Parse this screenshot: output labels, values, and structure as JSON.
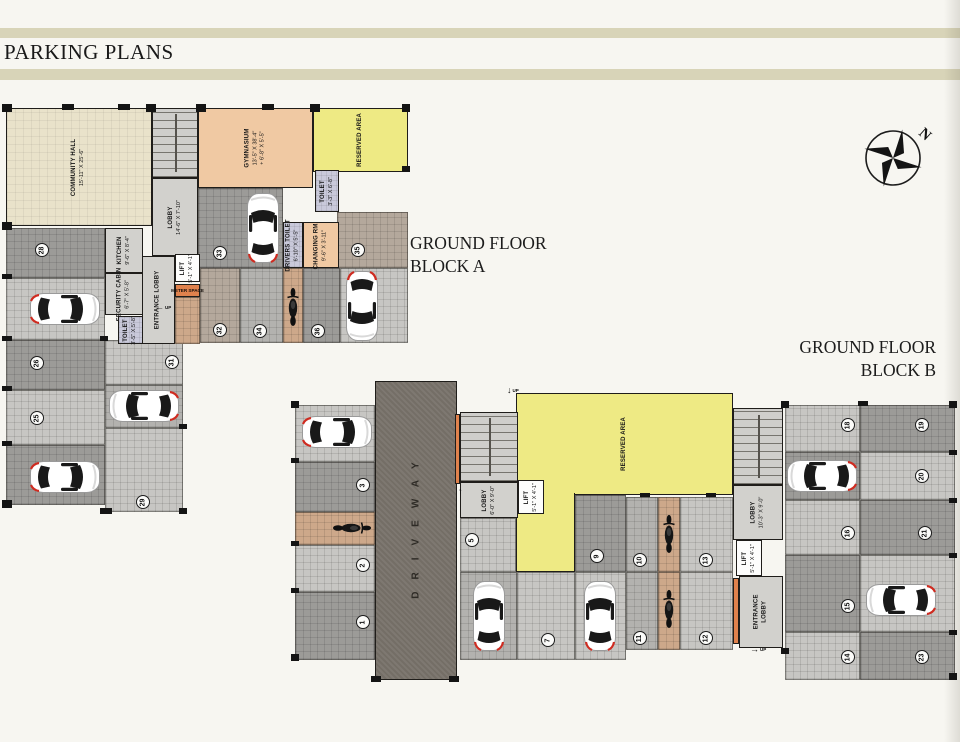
{
  "title": "PARKING PLANS",
  "compass_label": "N",
  "headings": {
    "block_a": [
      "GROUND FLOOR",
      "BLOCK A"
    ],
    "block_b": [
      "GROUND FLOOR",
      "BLOCK B"
    ]
  },
  "colors": {
    "paper": "#f7f6f1",
    "title_bar": "#d8d4b8",
    "reserved_yellow": "#eeea84",
    "gym_peach": "#f0c9a3",
    "hall_cream": "#e9e2ca",
    "toilet_lavender": "#c9c9da",
    "driveway_gray": "#746e66",
    "accent_orange": "#e0824d",
    "car_tail_red": "#cf2b20"
  },
  "block_a": {
    "rooms": {
      "community_hall": {
        "line1": "COMMUNITY HALL",
        "line2": "15'-11\" X 25'-6\""
      },
      "lobby": {
        "line1": "LOBBY",
        "line2": "14'-6\" X 7'-10\""
      },
      "gymnasium": {
        "line1": "GYMNASIUM",
        "line2": "13'-5\" X 38'-4\"",
        "line3": "+ 6'-8\" X 5'-5\""
      },
      "reserved": {
        "line1": "RESERVED AREA"
      },
      "toilet_top": {
        "line1": "TOILET",
        "line2": "3'-3\" X 6'-8\""
      },
      "kitchen": {
        "line1": "KITCHEN",
        "line2": "9'-6\" X 8'-4\""
      },
      "entrance_lobby": {
        "line1": "ENTRANCE LOBBY"
      },
      "lift": {
        "line1": "LIFT",
        "line2": "5'-1\" X 4'-1\""
      },
      "meter_space": {
        "line1": "METER SPACE"
      },
      "security_cabin": {
        "line1": "SECURITY CABIN",
        "line2": "6'-7\" X 5'-8\""
      },
      "toilet_small": {
        "line1": "TOILET",
        "line2": "3'-5\" X 5'-8\""
      },
      "drivers_toilet": {
        "line1": "DRIVERS TOILET",
        "line2": "6'-10\" X 5'-5\""
      },
      "changing_room": {
        "line1": "CHANGING RM.",
        "line2": "9'-6\" X 3'-11\""
      }
    },
    "floors": [
      [
        "s28",
        6,
        228,
        99,
        50,
        "tile-dark"
      ],
      [
        "s27",
        6,
        278,
        99,
        62,
        "tile-light"
      ],
      [
        "s26",
        6,
        340,
        99,
        50,
        "tile-dark"
      ],
      [
        "s25",
        6,
        390,
        99,
        55,
        "tile-light"
      ],
      [
        "s24",
        6,
        445,
        99,
        60,
        "tile-dark"
      ],
      [
        "s31",
        105,
        340,
        78,
        45,
        "tile-light"
      ],
      [
        "s30",
        105,
        385,
        78,
        43,
        "tile-mid"
      ],
      [
        "s29",
        105,
        428,
        78,
        84,
        "tile-light"
      ],
      [
        "s33",
        198,
        188,
        85,
        80,
        "tile-dark"
      ],
      [
        "s32",
        200,
        268,
        40,
        75,
        "tile-brown"
      ],
      [
        "s34",
        240,
        268,
        43,
        75,
        "tile-mid"
      ],
      [
        "moto-strip",
        283,
        268,
        20,
        75,
        "tile-orange"
      ],
      [
        "s36",
        303,
        268,
        37,
        75,
        "tile-dark"
      ],
      [
        "s35-car",
        340,
        268,
        68,
        75,
        "tile-light"
      ],
      [
        "s35-top",
        337,
        212,
        71,
        56,
        "tile-brown"
      ],
      [
        "corridor",
        175,
        297,
        25,
        47,
        "tile-orange"
      ]
    ],
    "spots": [
      {
        "num": 28,
        "x": 42,
        "y": 250
      },
      {
        "num": 26,
        "x": 37,
        "y": 363
      },
      {
        "num": 25,
        "x": 37,
        "y": 418
      },
      {
        "num": 31,
        "x": 172,
        "y": 362
      },
      {
        "num": 29,
        "x": 143,
        "y": 502
      },
      {
        "num": 33,
        "x": 220,
        "y": 253
      },
      {
        "num": 32,
        "x": 220,
        "y": 330
      },
      {
        "num": 34,
        "x": 260,
        "y": 331
      },
      {
        "num": 36,
        "x": 318,
        "y": 331
      },
      {
        "num": 35,
        "x": 358,
        "y": 250
      }
    ],
    "cars": [
      {
        "x": 65,
        "y": 309,
        "deg": 90
      },
      {
        "x": 65,
        "y": 477,
        "deg": 90
      },
      {
        "x": 144,
        "y": 406,
        "deg": -90
      },
      {
        "x": 263,
        "y": 228,
        "deg": 0
      },
      {
        "x": 362,
        "y": 306,
        "deg": 180
      }
    ],
    "motorcycles": [
      {
        "x": 293,
        "y": 307,
        "deg": 0
      }
    ]
  },
  "block_b": {
    "rooms": {
      "driveway": {
        "line1": "DRIVEWAY"
      },
      "lobby_left": {
        "line1": "LOBBY",
        "line2": "6'-0\" X 9'-0\""
      },
      "lift_left": {
        "line1": "LIFT",
        "line2": "5'-1\" X 4'-1\""
      },
      "reserved": {
        "line1": "RESERVED AREA"
      },
      "lobby_right": {
        "line1": "LOBBY",
        "line2": "10'-3\" X 9'-0\""
      },
      "lift_right": {
        "line1": "LIFT",
        "line2": "5'-1\" X 4'-1\""
      },
      "entrance_lobby": {
        "line1": "ENTRANCE",
        "line2": "LOBBY"
      }
    },
    "floors": [
      [
        "s4",
        295,
        405,
        80,
        57,
        "tile-light"
      ],
      [
        "s3",
        295,
        462,
        80,
        50,
        "tile-dark"
      ],
      [
        "moto-strip1",
        295,
        512,
        80,
        33,
        "tile-orange"
      ],
      [
        "s2",
        295,
        545,
        80,
        47,
        "tile-light"
      ],
      [
        "s1",
        295,
        592,
        80,
        68,
        "tile-dark"
      ],
      [
        "s5",
        460,
        518,
        56,
        54,
        "tile-light"
      ],
      [
        "s6",
        460,
        572,
        57,
        88,
        "tile-mid"
      ],
      [
        "s7",
        517,
        572,
        58,
        88,
        "tile-light"
      ],
      [
        "s9",
        575,
        495,
        51,
        77,
        "tile-dark"
      ],
      [
        "s8",
        575,
        572,
        51,
        88,
        "tile-light"
      ],
      [
        "s10",
        626,
        497,
        32,
        75,
        "tile-mid"
      ],
      [
        "moto-strip2",
        658,
        497,
        22,
        75,
        "tile-orange"
      ],
      [
        "s13",
        680,
        497,
        53,
        75,
        "tile-light"
      ],
      [
        "s11",
        626,
        572,
        32,
        78,
        "tile-mid"
      ],
      [
        "moto-strip3",
        658,
        572,
        22,
        78,
        "tile-orange"
      ],
      [
        "s12",
        680,
        572,
        53,
        78,
        "tile-light"
      ],
      [
        "s18",
        785,
        405,
        75,
        47,
        "tile-light"
      ],
      [
        "s19",
        860,
        405,
        95,
        47,
        "tile-dark"
      ],
      [
        "s17",
        785,
        452,
        75,
        48,
        "tile-dark"
      ],
      [
        "s20",
        860,
        452,
        95,
        48,
        "tile-light"
      ],
      [
        "s16",
        785,
        500,
        75,
        55,
        "tile-light"
      ],
      [
        "s21",
        860,
        500,
        95,
        55,
        "tile-dark"
      ],
      [
        "s15",
        785,
        555,
        75,
        77,
        "tile-dark"
      ],
      [
        "s22",
        860,
        555,
        95,
        77,
        "tile-light"
      ],
      [
        "s14",
        785,
        632,
        75,
        48,
        "tile-light"
      ],
      [
        "s23",
        860,
        632,
        95,
        48,
        "tile-dark"
      ]
    ],
    "spots": [
      {
        "num": 3,
        "x": 363,
        "y": 485
      },
      {
        "num": 2,
        "x": 363,
        "y": 565
      },
      {
        "num": 1,
        "x": 363,
        "y": 622
      },
      {
        "num": 5,
        "x": 472,
        "y": 540
      },
      {
        "num": 7,
        "x": 548,
        "y": 640
      },
      {
        "num": 9,
        "x": 597,
        "y": 556
      },
      {
        "num": 10,
        "x": 640,
        "y": 560
      },
      {
        "num": 13,
        "x": 706,
        "y": 560
      },
      {
        "num": 11,
        "x": 640,
        "y": 638
      },
      {
        "num": 12,
        "x": 706,
        "y": 638
      },
      {
        "num": 18,
        "x": 848,
        "y": 425
      },
      {
        "num": 19,
        "x": 922,
        "y": 425
      },
      {
        "num": 20,
        "x": 922,
        "y": 476
      },
      {
        "num": 16,
        "x": 848,
        "y": 533
      },
      {
        "num": 21,
        "x": 925,
        "y": 533
      },
      {
        "num": 15,
        "x": 848,
        "y": 606
      },
      {
        "num": 14,
        "x": 848,
        "y": 657
      },
      {
        "num": 23,
        "x": 922,
        "y": 657
      }
    ],
    "cars": [
      {
        "x": 337,
        "y": 432,
        "deg": 90
      },
      {
        "x": 489,
        "y": 616,
        "deg": 0
      },
      {
        "x": 600,
        "y": 616,
        "deg": 0
      },
      {
        "x": 822,
        "y": 476,
        "deg": -90
      },
      {
        "x": 901,
        "y": 600,
        "deg": -90
      }
    ],
    "motorcycles": [
      {
        "x": 352,
        "y": 528,
        "deg": 90
      },
      {
        "x": 669,
        "y": 534,
        "deg": 0
      },
      {
        "x": 669,
        "y": 609,
        "deg": 0
      }
    ]
  },
  "arrows": [
    {
      "x": 155,
      "y": 303,
      "glyph": "←",
      "label": "UP"
    },
    {
      "x": 507,
      "y": 386,
      "glyph": "↓",
      "label": "UP"
    },
    {
      "x": 458,
      "y": 487,
      "glyph": "↑",
      "label": ""
    },
    {
      "x": 750,
      "y": 645,
      "glyph": "→",
      "label": "UP"
    }
  ],
  "wall_ticks": [
    [
      2,
      104,
      10,
      8
    ],
    [
      62,
      104,
      12,
      6
    ],
    [
      118,
      104,
      12,
      6
    ],
    [
      146,
      104,
      10,
      8
    ],
    [
      196,
      104,
      10,
      8
    ],
    [
      262,
      104,
      12,
      6
    ],
    [
      310,
      104,
      10,
      8
    ],
    [
      402,
      104,
      8,
      8
    ],
    [
      402,
      166,
      8,
      6
    ],
    [
      2,
      222,
      10,
      8
    ],
    [
      2,
      274,
      10,
      5
    ],
    [
      2,
      336,
      10,
      5
    ],
    [
      2,
      386,
      10,
      5
    ],
    [
      2,
      441,
      10,
      5
    ],
    [
      2,
      500,
      10,
      8
    ],
    [
      100,
      508,
      12,
      6
    ],
    [
      179,
      508,
      8,
      6
    ],
    [
      179,
      424,
      8,
      5
    ],
    [
      100,
      336,
      8,
      5
    ],
    [
      291,
      401,
      8,
      7
    ],
    [
      291,
      458,
      8,
      5
    ],
    [
      291,
      541,
      8,
      5
    ],
    [
      291,
      588,
      8,
      5
    ],
    [
      291,
      654,
      8,
      7
    ],
    [
      371,
      676,
      10,
      6
    ],
    [
      449,
      676,
      10,
      6
    ],
    [
      781,
      401,
      8,
      7
    ],
    [
      858,
      401,
      10,
      5
    ],
    [
      949,
      401,
      8,
      7
    ],
    [
      949,
      450,
      8,
      5
    ],
    [
      949,
      498,
      8,
      5
    ],
    [
      949,
      553,
      8,
      5
    ],
    [
      949,
      630,
      8,
      5
    ],
    [
      949,
      673,
      8,
      7
    ],
    [
      781,
      648,
      8,
      6
    ],
    [
      640,
      493,
      10,
      4
    ],
    [
      706,
      493,
      10,
      4
    ]
  ]
}
